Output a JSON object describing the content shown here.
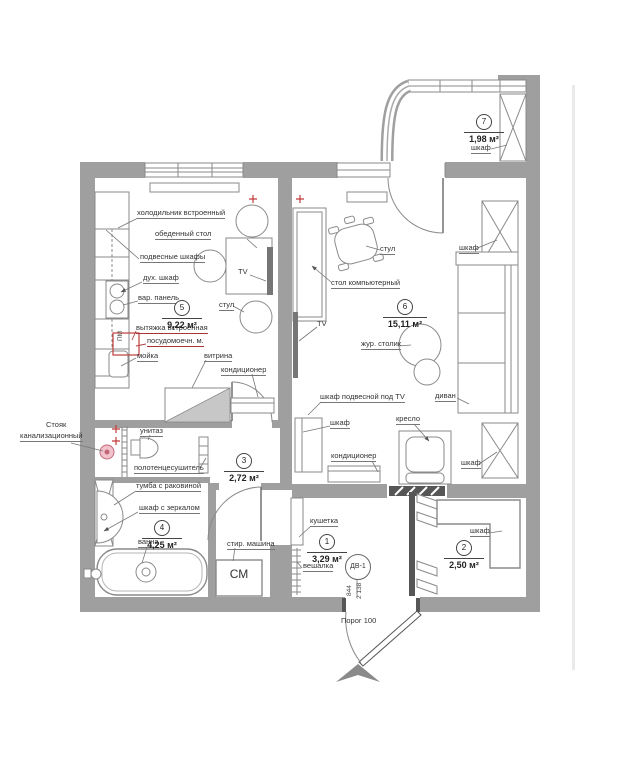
{
  "rooms": {
    "r1": {
      "num": "1",
      "area": "3,29 м²"
    },
    "r2": {
      "num": "2",
      "area": "2,50 м²"
    },
    "r3": {
      "num": "3",
      "area": "2,72 м²"
    },
    "r4": {
      "num": "4",
      "area": "4,25 м²"
    },
    "r5": {
      "num": "5",
      "area": "9,22 м²"
    },
    "r6": {
      "num": "6",
      "area": "15,11 м²"
    },
    "r7": {
      "num": "7",
      "area": "1,98 м²"
    }
  },
  "labels": {
    "fridge": "холодильник встроенный",
    "dining_table": "обеденный стол",
    "hanging_cabinets": "подвесные шкафы",
    "oven": "дух. шкаф",
    "cooktop": "вар. панель",
    "hood": "вытяжка встроенная",
    "dishwasher": "посудомоечн. м.",
    "sink": "мойка",
    "vitrina": "витрина",
    "ac_kitchen": "кондиционер",
    "tv_kitchen": "TV",
    "chair_kitchen": "стул",
    "pm": "ПМ",
    "chair_living": "стул",
    "wardrobe_top": "шкаф",
    "computer_desk": "стол компьютерный",
    "tv_living": "TV",
    "coffee_table": "жур. столик",
    "tv_wall_cabinet": "шкаф подвесной под TV",
    "sofa": "диван",
    "cabinet_living_left": "шкаф",
    "armchair": "кресло",
    "ac_living": "кондиционер",
    "wardrobe_bottom": "шкаф",
    "wardrobe_balcony": "шкаф",
    "riser_line1": "Стояк",
    "riser_line2": "канализационный",
    "toilet": "унитаз",
    "towel_dryer": "полотенцесушитель",
    "vanity": "тумба с раковиной",
    "mirror_cabinet": "шкаф с зеркалом",
    "bath": "ванна",
    "washer": "стир. машина",
    "washer_mark": "СМ",
    "couch": "кушетка",
    "hanger": "вешалка",
    "door_tag": "ДВ-1",
    "threshold": "Порог 100",
    "wardrobe_room2": "шкаф"
  },
  "dims": {
    "door_width": "844",
    "door_height": "2 138"
  },
  "colors": {
    "wall": "#9f9f9f",
    "accent_red": "#c23b3b",
    "riser_pink": "#f3c3cd"
  }
}
